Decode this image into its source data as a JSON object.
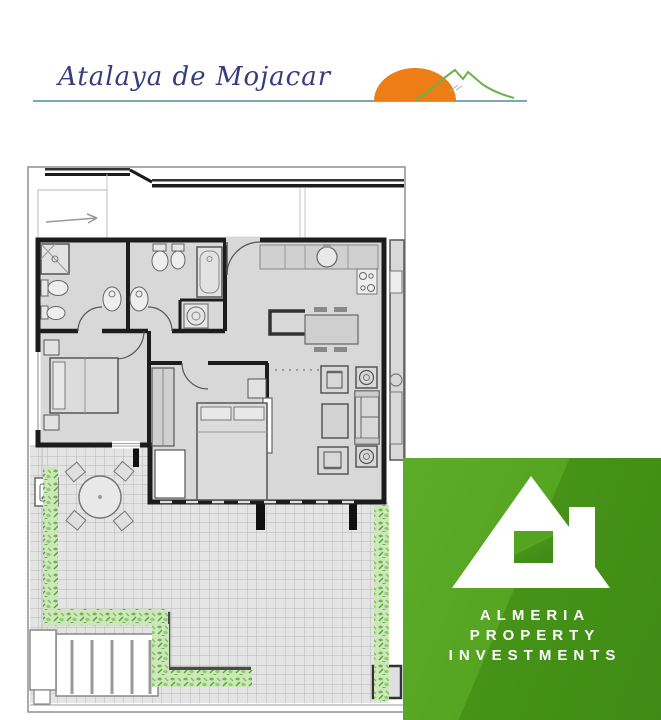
{
  "header": {
    "brand": "Atalaya de Mojacar",
    "text_color": "#383c7e",
    "underline_color": "#7ba8b6",
    "sun_color": "#ee7d15",
    "mountain_color": "#6cb14c"
  },
  "floor_plan": {
    "description": "apartment floor plan with two bedrooms, two bathrooms, kitchen, living room and tiled terrace",
    "wall_color": "#1c1c1c",
    "floor_color": "#d8d8d8",
    "tile_color": "#e4e4e4",
    "tile_line_color": "#b9b9b9",
    "hedge_color": "#6db54d"
  },
  "badge": {
    "line1": "ALMERIA",
    "line2": "PROPERTY",
    "line3": "INVESTMENTS",
    "bg_light": "#55a522",
    "bg_dark": "#3f8b15",
    "house_color": "#ffffff"
  }
}
